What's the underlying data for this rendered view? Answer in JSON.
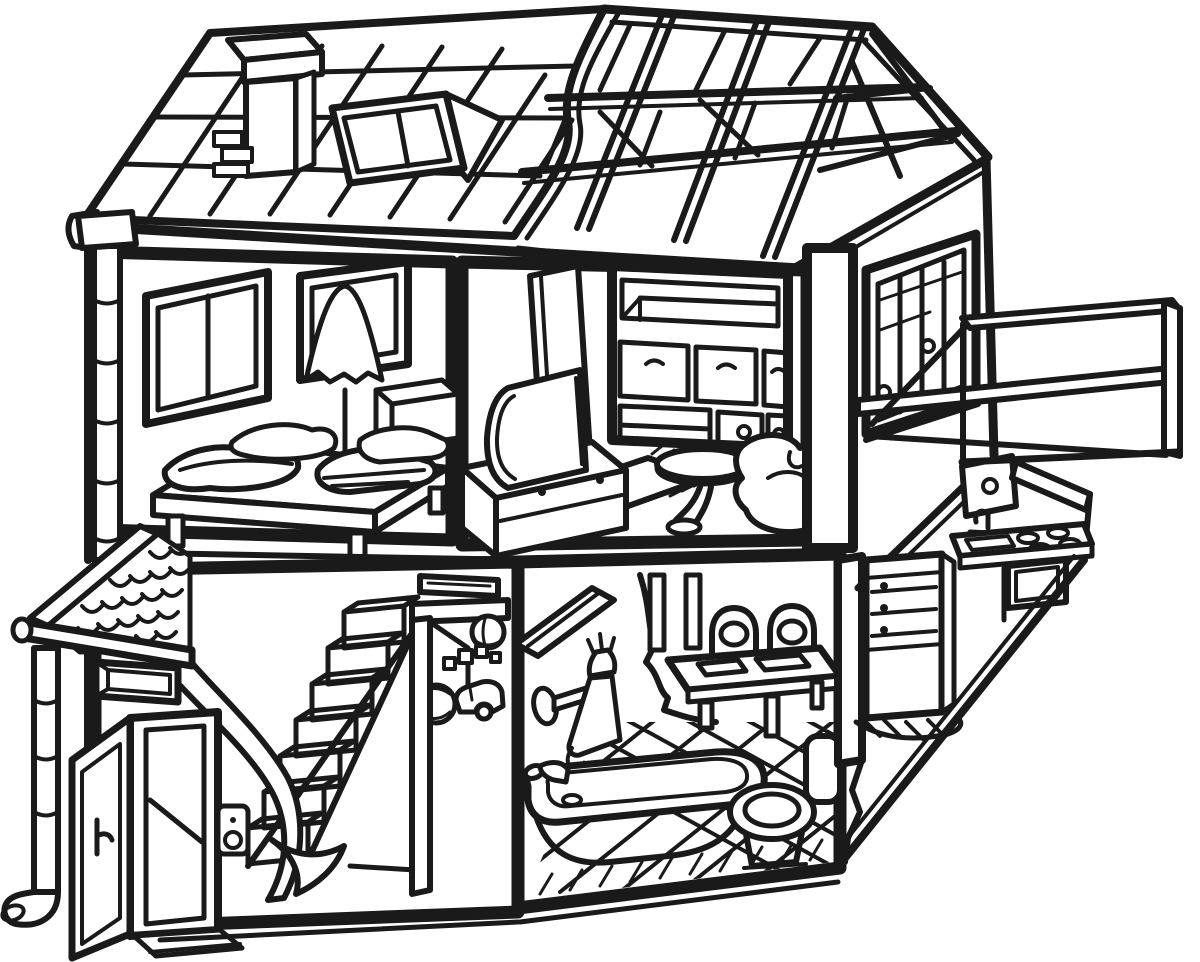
{
  "scene": {
    "subject": "Two-story dollhouse cutaway coloring page, black line art on white",
    "style": {
      "kind": "line-art coloring page",
      "line_color": "#1a1a1a",
      "background_color": "#ffffff"
    },
    "exterior": {
      "roof": {
        "items": [
          "tiled roof slope",
          "chimney with cap",
          "skylight window with open flap",
          "peeled tear edge",
          "exposed rafter framing",
          "gable end truss"
        ]
      },
      "left_side": {
        "items": [
          "rain gutter end cap",
          "segmented downspout",
          "porch roof with fish-scale shingles",
          "porch fascia board",
          "slot window",
          "open front door with handle",
          "threshold step",
          "downspout elbow with open end"
        ]
      },
      "right_side": {
        "items": [
          "corner post",
          "picture window with mullions",
          "door knobs seen through window",
          "balcony with open railing",
          "diagonal cutaway edge with hatching"
        ]
      }
    },
    "upper_floor": {
      "bedroom": {
        "label": "bedroom",
        "items": [
          "two-pane window",
          "single window",
          "floor lamp with ruffled shade",
          "platform bed on legs",
          "stacked pillows",
          "folded blankets",
          "storage chest"
        ]
      },
      "living_room": {
        "label": "living room",
        "items": [
          "standing screen panel",
          "CRT television",
          "TV cabinet with drawer knobs",
          "fringed rug",
          "wall unit with open shelf and drawers",
          "cabinet doors with round knobs",
          "pedestal side table",
          "beanbag armchair"
        ]
      }
    },
    "lower_floor": {
      "hallway": {
        "label": "hallway and stairs",
        "items": [
          "staircase",
          "curved banister wall with scroll",
          "wall plaque",
          "open interior door",
          "beach ball",
          "toy blocks",
          "toy car",
          "half-hidden ball",
          "light switch"
        ]
      },
      "bathroom": {
        "label": "bathroom",
        "items": [
          "wall shelf",
          "wall-mounted shower mixer",
          "bathtub with faucet",
          "soap",
          "toilet with raised lid",
          "diagonal floor tiles"
        ]
      },
      "dining_nook": {
        "label": "dining nook",
        "items": [
          "curtain divider",
          "window strips",
          "dining table",
          "two chairs with oval cut-out backs",
          "placemats"
        ]
      },
      "kitchen": {
        "label": "kitchen (cutaway)",
        "items": [
          "refrigerator with freezer drawers",
          "upper cabinet with knob",
          "range hood shelf",
          "sink with faucet",
          "four-burner cooktop",
          "oven",
          "torn floor edge with hatching"
        ]
      }
    }
  }
}
